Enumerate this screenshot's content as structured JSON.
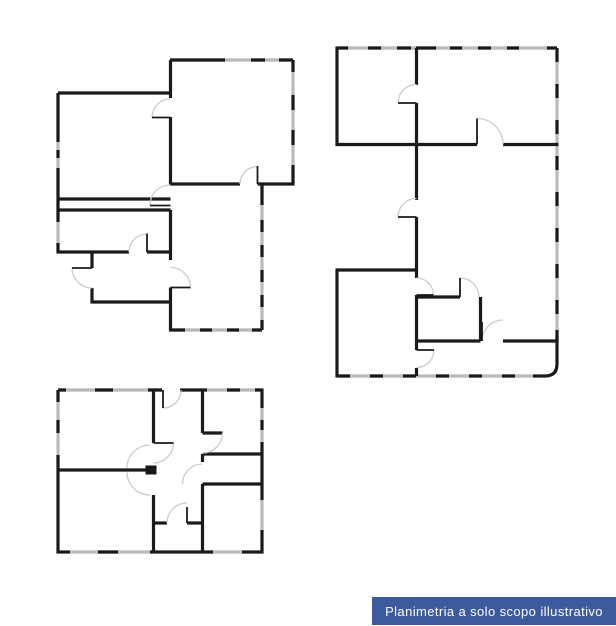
{
  "page": {
    "width": 616,
    "height": 626
  },
  "colors": {
    "wall": "#1a1a1a",
    "window": "#b9b9b9",
    "arc": "#cccccc",
    "label_bg": "#3d5a9e",
    "label_fg": "#ffffff",
    "bg": "#ffffff"
  },
  "disclaimer": {
    "text": "Planimetria a solo scopo illustrativo"
  },
  "plans": {
    "upper_left": {
      "id": "floor-plan-upper-left"
    },
    "right": {
      "id": "floor-plan-right"
    },
    "lower_left": {
      "id": "floor-plan-lower-left"
    }
  }
}
